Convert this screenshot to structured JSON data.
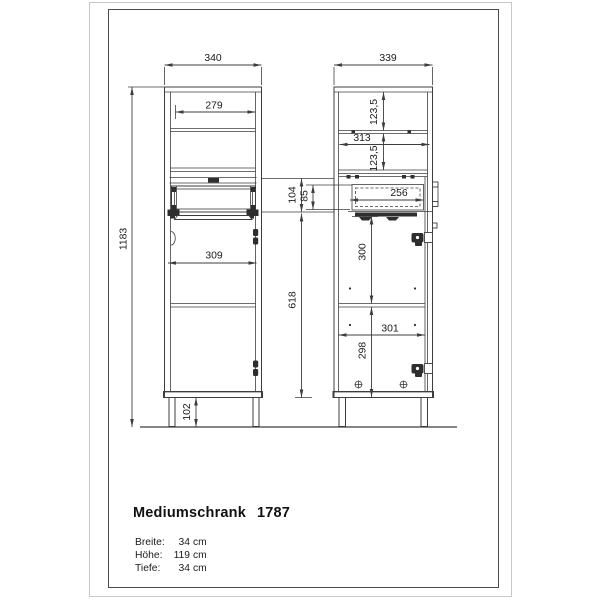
{
  "drawing": {
    "front": {
      "width": "340",
      "shelf_width": "279",
      "height": "1183",
      "door_width": "309",
      "leg_height": "102"
    },
    "side": {
      "depth": "339",
      "shelf_upper": "123,5",
      "inner_depth": "313",
      "shelf_lower": "123,5",
      "drawer_zone": "104",
      "drawer_front": "85",
      "drawer_depth": "256",
      "lower_height": "618",
      "door_upper": "300",
      "lower_inner": "301",
      "door_lower": "298"
    }
  },
  "title_block": {
    "name": "Mediumschrank",
    "model": "1787",
    "specs": [
      {
        "label": "Breite:",
        "value": "34",
        "unit": "cm"
      },
      {
        "label": "Höhe:",
        "value": "119",
        "unit": "cm"
      },
      {
        "label": "Tiefe:",
        "value": "34",
        "unit": "cm"
      }
    ]
  }
}
